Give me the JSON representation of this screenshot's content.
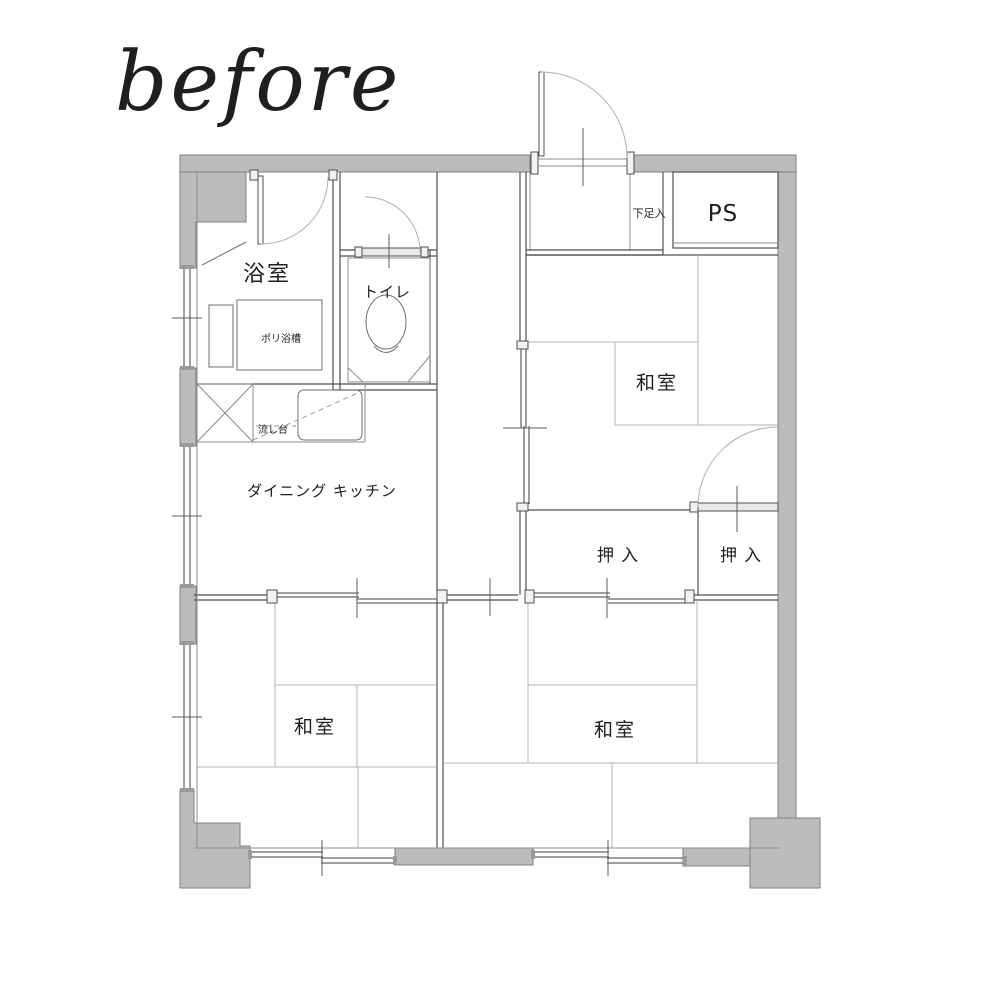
{
  "header": {
    "title": "before"
  },
  "colors": {
    "wall_fill": "#bcbcbc",
    "wall_stroke": "#7f7f7f",
    "interior_line": "#4f4f4f",
    "tatami_line": "#b5b5b5",
    "door_arc": "#b0b0b0",
    "text": "#1f1f1f",
    "background": "#ffffff"
  },
  "rooms": {
    "bathroom": "浴室",
    "toilet": "トイレ",
    "bathtub": "ポリ浴槽",
    "sink": "流し台",
    "dining_kitchen": "ダイニング キッチン",
    "washitsu_top_right": "和室",
    "washitsu_bottom_left": "和室",
    "washitsu_bottom_right": "和室",
    "closet_left": "押入",
    "closet_right": "押入",
    "pipe_space": "PS",
    "shoe_cabinet": "下足入"
  }
}
